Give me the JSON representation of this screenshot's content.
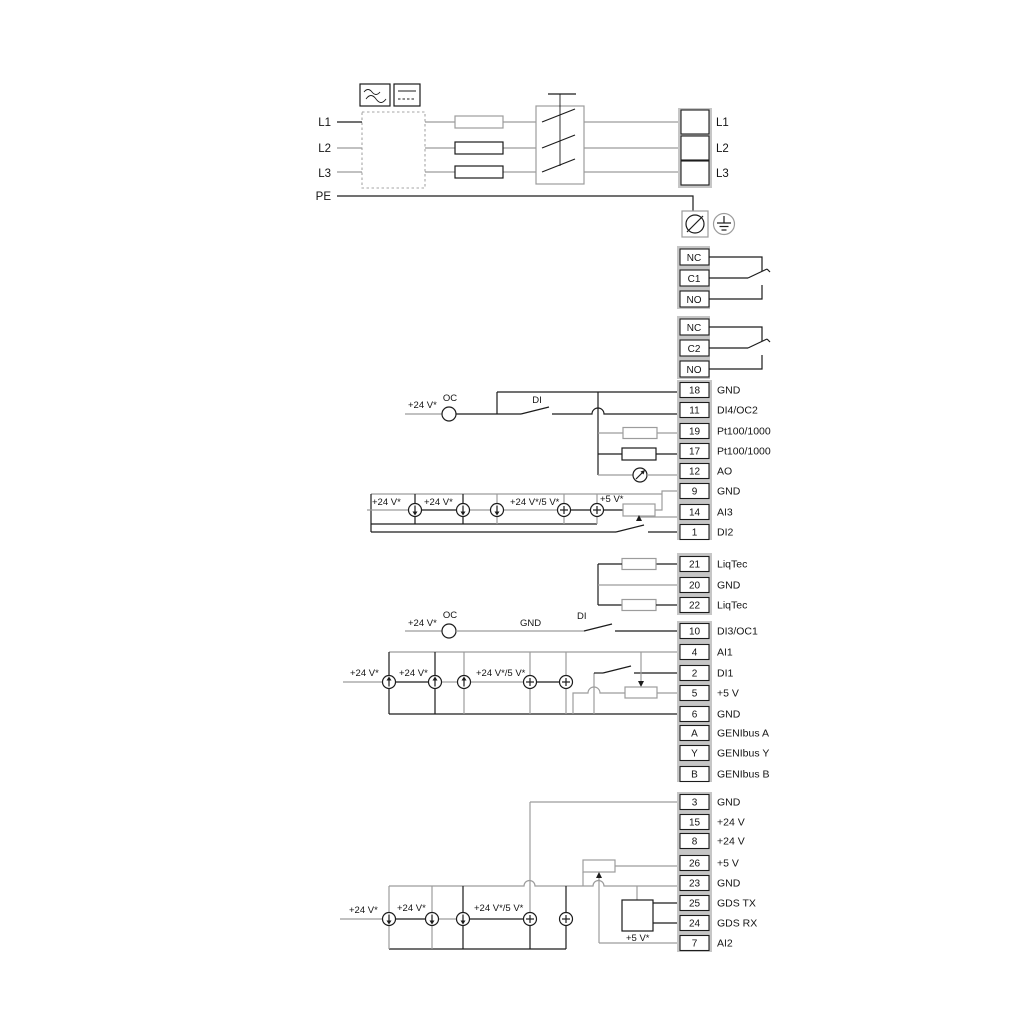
{
  "power": {
    "left": [
      "L1",
      "L2",
      "L3",
      "PE"
    ],
    "right": [
      "L1",
      "L2",
      "L3"
    ]
  },
  "relays": {
    "r1": [
      "NC",
      "C1",
      "NO"
    ],
    "r2": [
      "NC",
      "C2",
      "NO"
    ]
  },
  "strip1": [
    {
      "n": "18",
      "l": "GND"
    },
    {
      "n": "11",
      "l": "DI4/OC2"
    },
    {
      "n": "19",
      "l": "Pt100/1000"
    },
    {
      "n": "17",
      "l": "Pt100/1000"
    },
    {
      "n": "12",
      "l": "AO"
    },
    {
      "n": "9",
      "l": "GND"
    },
    {
      "n": "14",
      "l": "AI3"
    },
    {
      "n": "1",
      "l": "DI2"
    }
  ],
  "liqtec": [
    {
      "n": "21",
      "l": "LiqTec"
    },
    {
      "n": "20",
      "l": "GND"
    },
    {
      "n": "22",
      "l": "LiqTec"
    }
  ],
  "strip2": [
    {
      "n": "10",
      "l": "DI3/OC1"
    },
    {
      "n": "4",
      "l": "AI1"
    },
    {
      "n": "2",
      "l": "DI1"
    },
    {
      "n": "5",
      "l": "+5 V"
    },
    {
      "n": "6",
      "l": "GND"
    },
    {
      "n": "A",
      "l": "GENIbus A"
    },
    {
      "n": "Y",
      "l": "GENIbus Y"
    },
    {
      "n": "B",
      "l": "GENIbus B"
    }
  ],
  "strip3": [
    {
      "n": "3",
      "l": "GND"
    },
    {
      "n": "15",
      "l": "+24 V"
    },
    {
      "n": "8",
      "l": "+24 V"
    },
    {
      "n": "26",
      "l": "+5 V"
    },
    {
      "n": "23",
      "l": "GND"
    },
    {
      "n": "25",
      "l": "GDS TX"
    },
    {
      "n": "24",
      "l": "GDS RX"
    },
    {
      "n": "7",
      "l": "AI2"
    }
  ],
  "ann": {
    "row11_v24": "+24 V*",
    "row11_oc": "OC",
    "row11_di": "DI",
    "row10_v24": "+24 V*",
    "row10_oc": "OC",
    "row10_gnd": "GND",
    "row10_di": "DI",
    "ai3_v24a": "+24 V*",
    "ai3_v24b": "+24 V*",
    "ai3_v245": "+24 V*/5 V*",
    "ai3_v5": "+5 V*",
    "ai1_v24a": "+24 V*",
    "ai1_v24b": "+24 V*",
    "ai1_v245": "+24 V*/5 V*",
    "ai2_v24a": "+24 V*",
    "ai2_v24b": "+24 V*",
    "ai2_v245": "+24 V*/5 V*",
    "ai2_v5": "+5 V*"
  },
  "colors": {
    "wire_gray": "#9c9c9c",
    "wire_black": "#1c1c1c",
    "terminal_backdrop": "#c6c6c6"
  }
}
